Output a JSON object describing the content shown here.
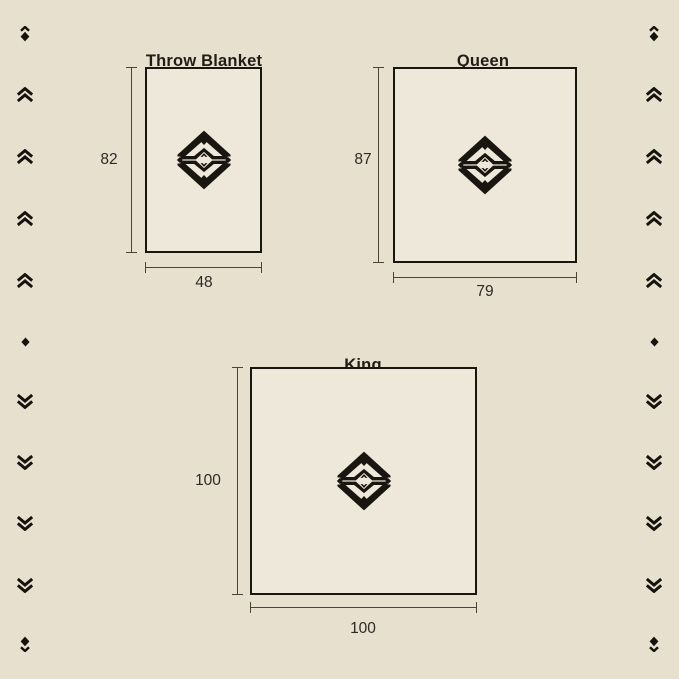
{
  "page": {
    "background_color": "#e7e0cf",
    "ink_color": "#19150f"
  },
  "blankets": [
    {
      "name": "Throw Blanket",
      "height": "82",
      "width": "48"
    },
    {
      "name": "Queen",
      "height": "87",
      "width": "79"
    },
    {
      "name": "King",
      "height": "100",
      "width": "100"
    }
  ],
  "ornaments": {
    "pattern": [
      "diamond-chevron-up",
      "double-chevron-up",
      "double-chevron-up",
      "double-chevron-up",
      "double-chevron-up",
      "diamond",
      "double-chevron-down",
      "double-chevron-down",
      "double-chevron-down",
      "double-chevron-down",
      "diamond-chevron-down"
    ]
  }
}
